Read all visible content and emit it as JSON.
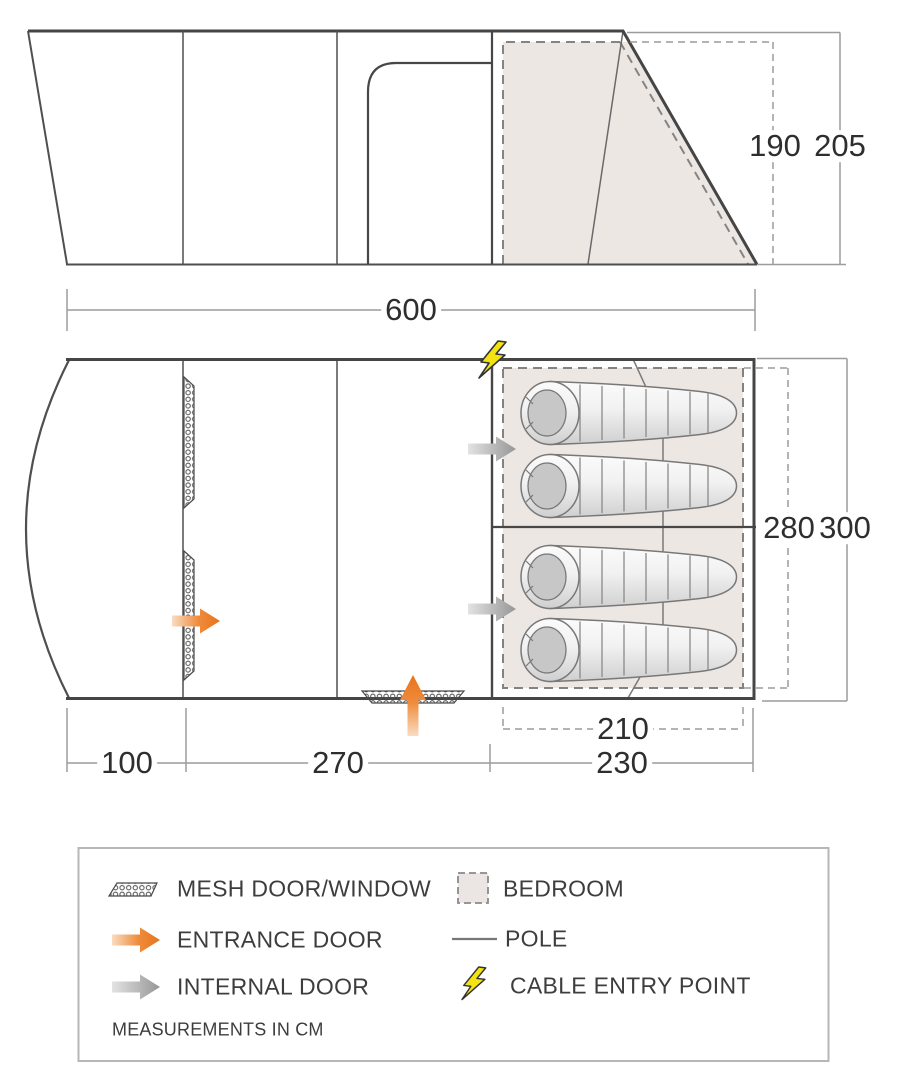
{
  "dims": {
    "total_width": "600",
    "inner_height": "190",
    "peak_height": "205",
    "inner_depth": "280",
    "total_depth": "300",
    "bedroom_inner_width": "210",
    "porch_width": "100",
    "living_width": "270",
    "bedroom_width": "230"
  },
  "legend": {
    "items": [
      {
        "icon": "mesh-swatch-icon",
        "label": "MESH DOOR/WINDOW"
      },
      {
        "icon": "entrance-arrow-icon",
        "label": "ENTRANCE DOOR"
      },
      {
        "icon": "internal-arrow-icon",
        "label": "INTERNAL DOOR"
      },
      {
        "icon": "bedroom-swatch-icon",
        "label": "BEDROOM"
      },
      {
        "icon": "pole-line-icon",
        "label": "POLE"
      },
      {
        "icon": "lightning-bolt-icon",
        "label": "CABLE ENTRY POINT"
      }
    ],
    "note": "MEASUREMENTS IN CM"
  },
  "colors": {
    "accent_orange": "#E8731C",
    "arrow_gray": "#9E9E9E",
    "bedroom_fill": "#EDE7E4",
    "cable_yellow": "#F3E312",
    "wall_dark": "#454545",
    "dimension_gray": "#9C9C9C"
  }
}
